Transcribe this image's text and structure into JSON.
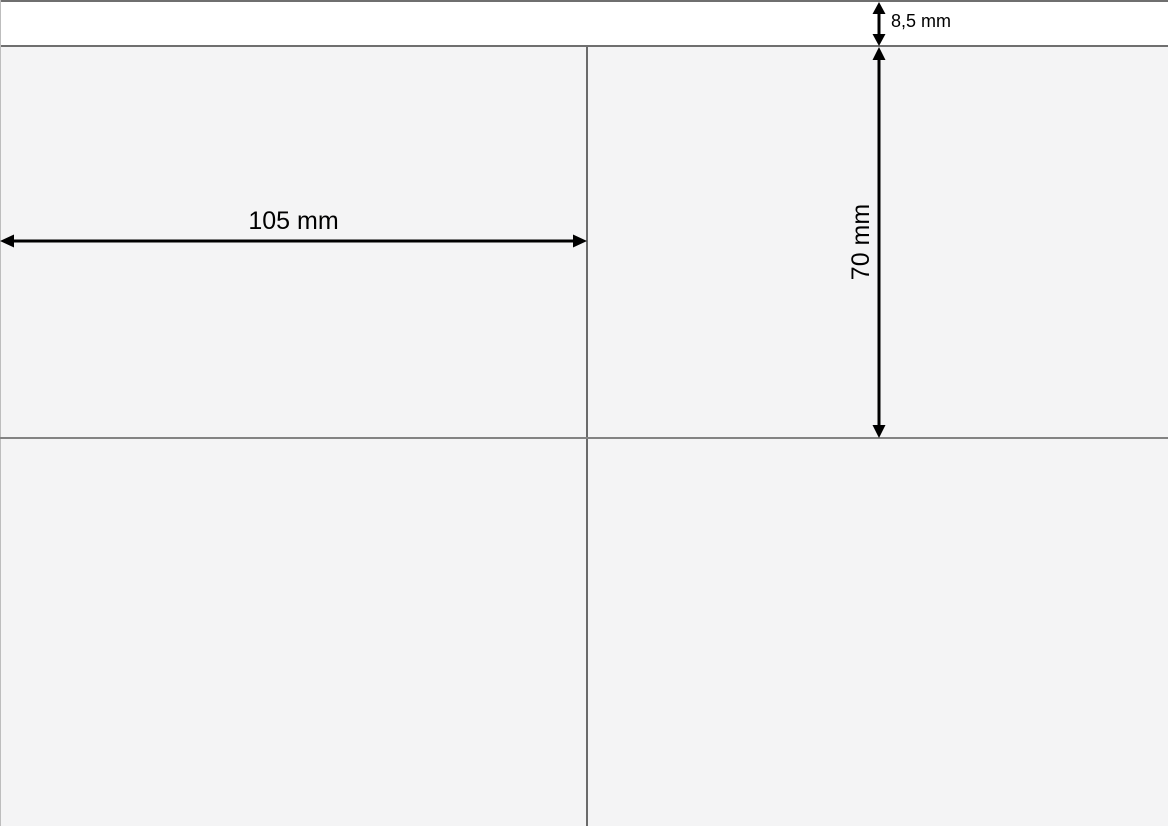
{
  "diagram": {
    "type": "label-sheet-dimension-drawing",
    "dimensions": {
      "label_width": "105 mm",
      "label_height": "70 mm",
      "top_margin": "8,5 mm"
    },
    "layout": {
      "columns": 2,
      "visible_rows": 2
    },
    "colors": {
      "sheet_background": "#f4f4f5",
      "top_margin_strip": "#ffffff",
      "frame_line": "#6f6f6f",
      "cell_divider": "#838383",
      "sheet_edge": "#bdbdbd",
      "dimension_arrow": "#000000",
      "dimension_text": "#000000"
    }
  }
}
